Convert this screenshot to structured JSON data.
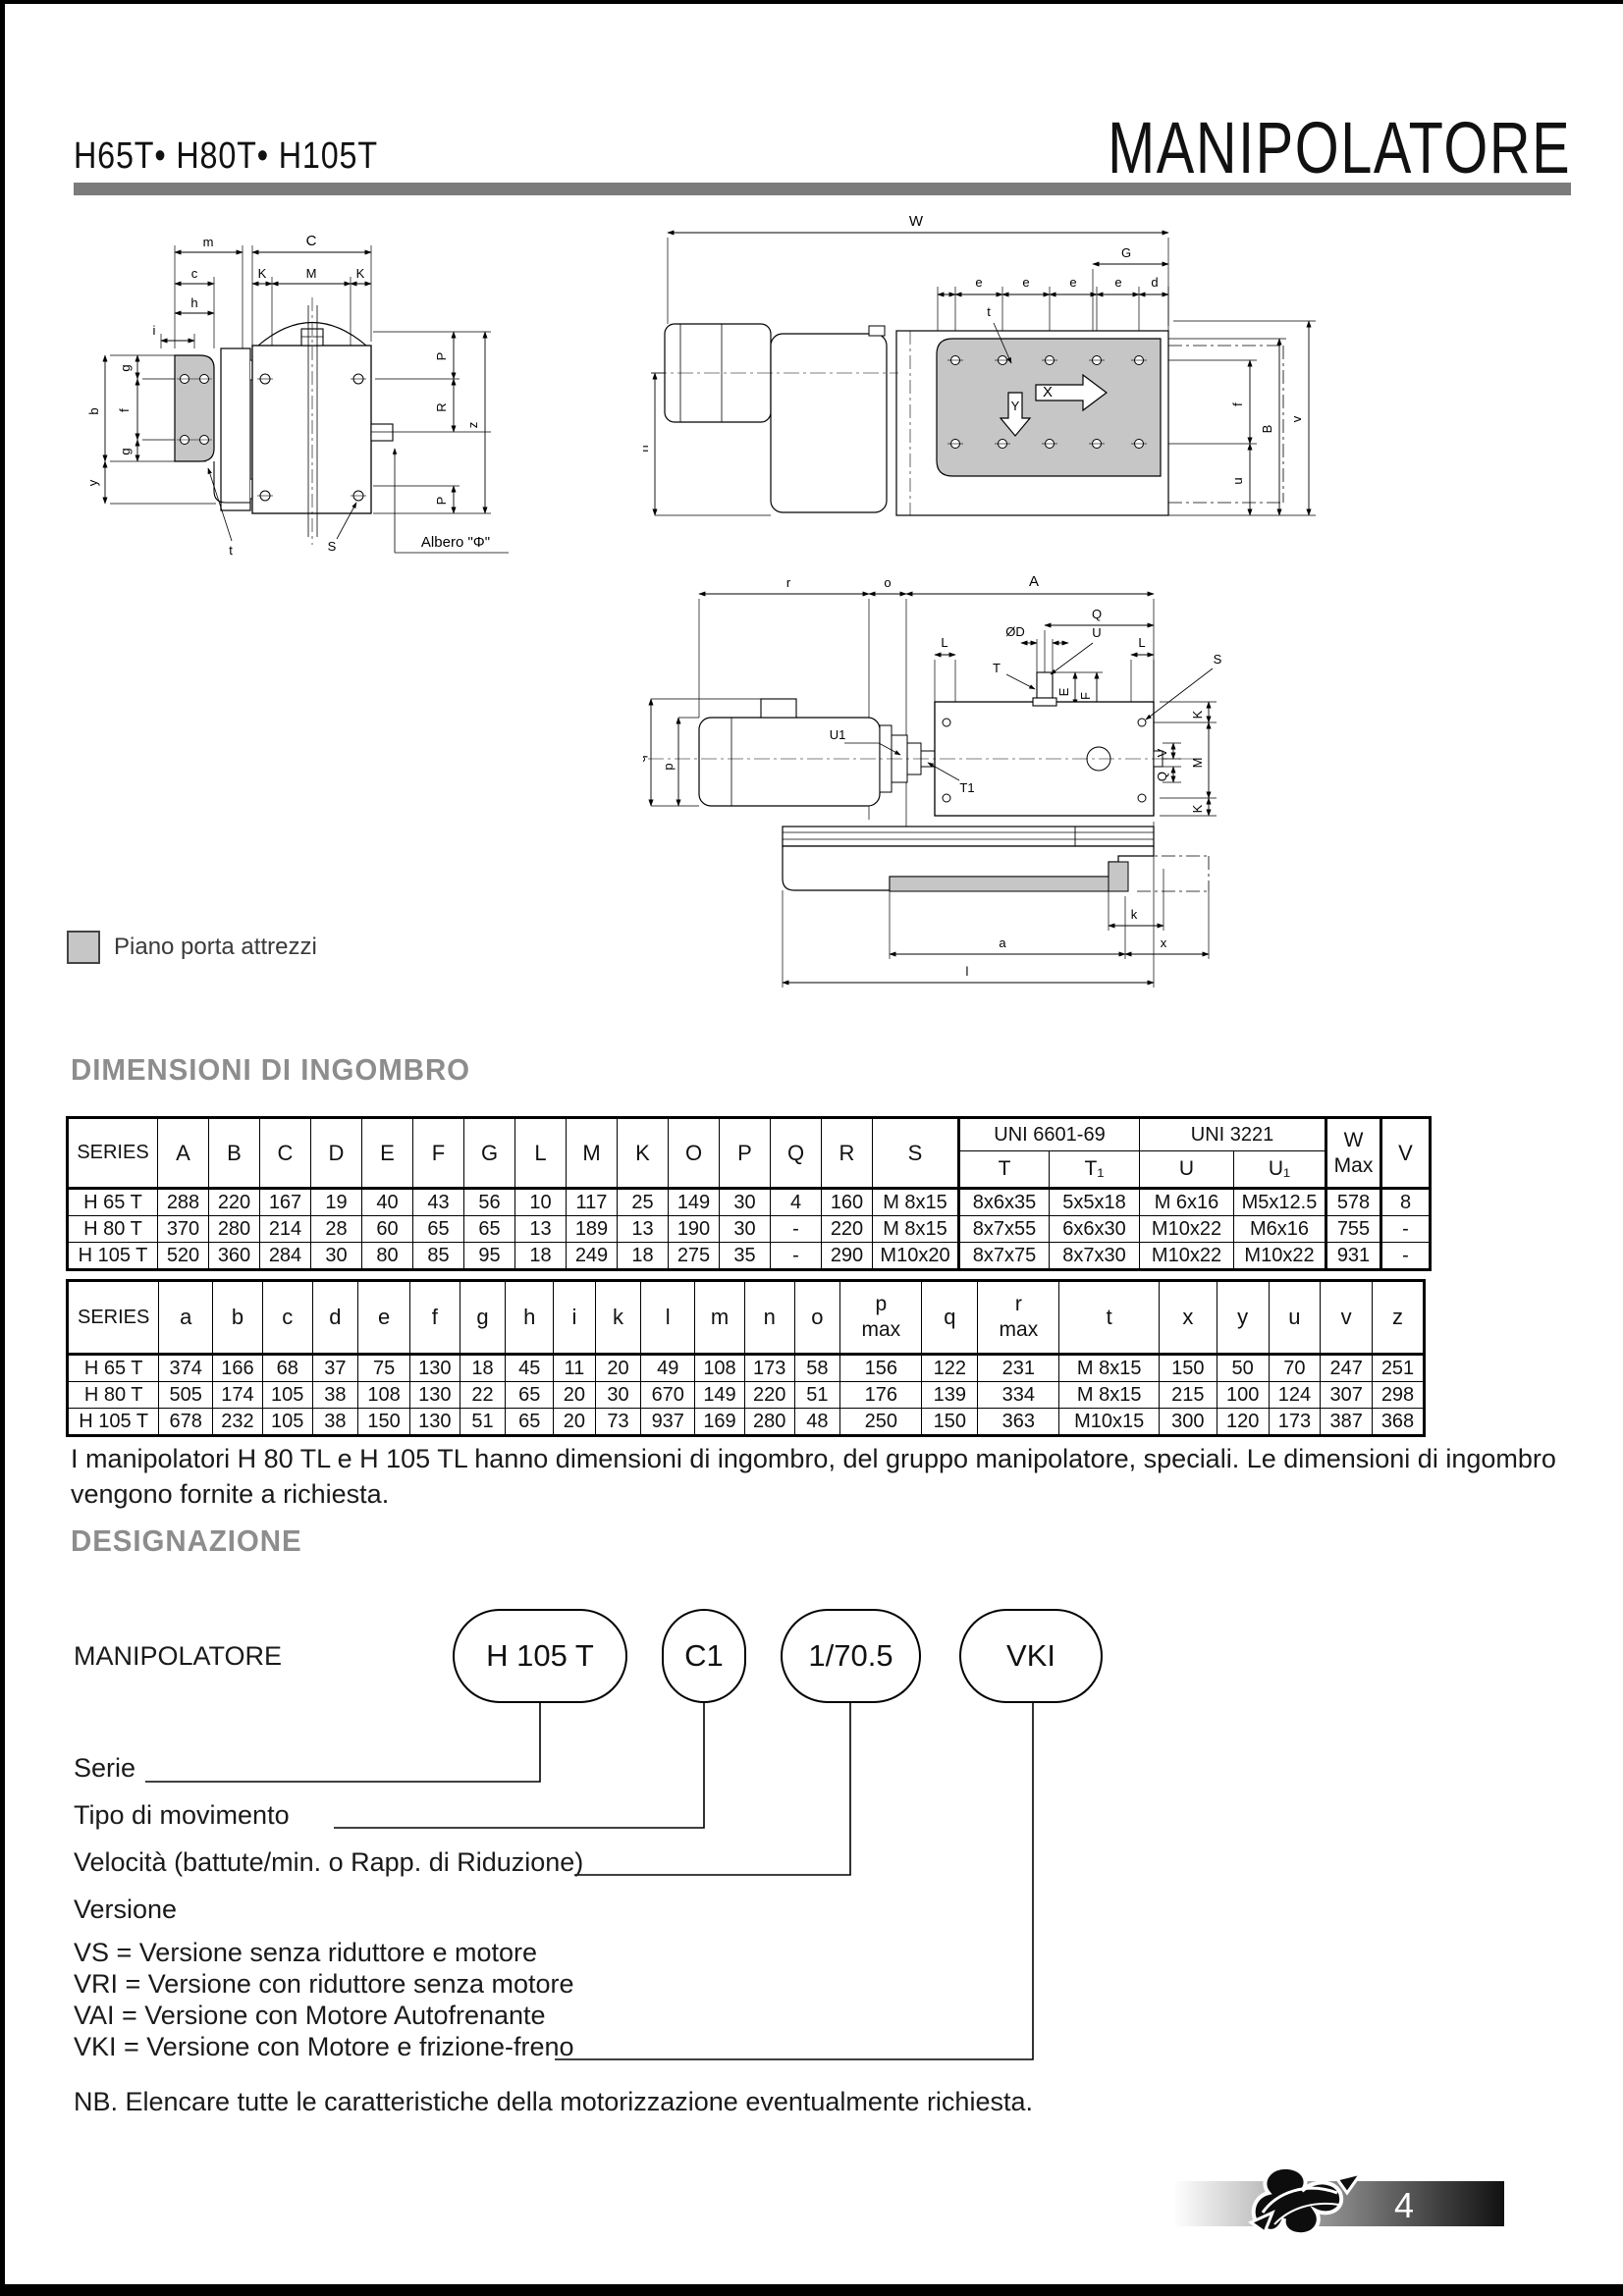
{
  "header": {
    "models": "H65T• H80T• H105T",
    "title": "MANIPOLATORE"
  },
  "legend": {
    "label": "Piano porta attrezzi"
  },
  "headings": {
    "dimensioni": "DIMENSIONI DI INGOMBRO",
    "designazione": "DESIGNAZIONE"
  },
  "drawing1": {
    "m": "m",
    "C": "C",
    "c": "c",
    "K": "K",
    "M": "M",
    "h": "h",
    "i": "i",
    "g": "g",
    "f": "f",
    "b": "b",
    "y": "y",
    "P": "P",
    "R": "R",
    "z": "z",
    "t": "t",
    "S": "S",
    "albero": "Albero \"Φ\""
  },
  "drawing2": {
    "W": "W",
    "G": "G",
    "e": "e",
    "d": "d",
    "t": "t",
    "f": "f",
    "B": "B",
    "u": "u",
    "v": "v",
    "n": "n",
    "X": "X",
    "Y": "Y"
  },
  "drawing3": {
    "r": "r",
    "o": "o",
    "A": "A",
    "Q": "Q",
    "OD": "ØD",
    "U": "U",
    "L": "L",
    "T": "T",
    "E": "E",
    "F": "F",
    "S": "S",
    "q": "q",
    "p": "p",
    "U1": "U1",
    "T1": "T1",
    "V": "V",
    "M": "M",
    "K": "K",
    "k": "k",
    "a": "a",
    "x": "x",
    "l": "l"
  },
  "table1": {
    "series_header": "SERIES",
    "letters": [
      "A",
      "B",
      "C",
      "D",
      "E",
      "F",
      "G",
      "L",
      "M",
      "K",
      "O",
      "P",
      "Q",
      "R",
      "S"
    ],
    "uni1_label": "UNI 6601-69",
    "uni2_label": "UNI 3221",
    "sub_headers": [
      "T",
      "T₁",
      "U",
      "U₁"
    ],
    "w_header": [
      "W",
      "Max"
    ],
    "v_header": "V",
    "rows": [
      [
        "H 65 T",
        "288",
        "220",
        "167",
        "19",
        "40",
        "43",
        "56",
        "10",
        "117",
        "25",
        "149",
        "30",
        "4",
        "160",
        "M 8x15",
        "8x6x35",
        "5x5x18",
        "M 6x16",
        "M5x12.5",
        "578",
        "8"
      ],
      [
        "H 80 T",
        "370",
        "280",
        "214",
        "28",
        "60",
        "65",
        "65",
        "13",
        "189",
        "13",
        "190",
        "30",
        "-",
        "220",
        "M 8x15",
        "8x7x55",
        "6x6x30",
        "M10x22",
        "M6x16",
        "755",
        "-"
      ],
      [
        "H 105 T",
        "520",
        "360",
        "284",
        "30",
        "80",
        "85",
        "95",
        "18",
        "249",
        "18",
        "275",
        "35",
        "-",
        "290",
        "M10x20",
        "8x7x75",
        "8x7x30",
        "M10x22",
        "M10x22",
        "931",
        "-"
      ]
    ]
  },
  "table2": {
    "series_header": "SERIES",
    "letters": [
      "a",
      "b",
      "c",
      "d",
      "e",
      "f",
      "g",
      "h",
      "i",
      "k",
      "l",
      "m",
      "n",
      "o"
    ],
    "pmax": [
      "p",
      "max"
    ],
    "q_header": "q",
    "rmax": [
      "r",
      "max"
    ],
    "tail_letters": [
      "t",
      "x",
      "y",
      "u",
      "v",
      "z"
    ],
    "rows": [
      [
        "H 65 T",
        "374",
        "166",
        "68",
        "37",
        "75",
        "130",
        "18",
        "45",
        "11",
        "20",
        "49",
        "108",
        "173",
        "58",
        "156",
        "122",
        "231",
        "M 8x15",
        "150",
        "50",
        "70",
        "247",
        "251"
      ],
      [
        "H 80 T",
        "505",
        "174",
        "105",
        "38",
        "108",
        "130",
        "22",
        "65",
        "20",
        "30",
        "670",
        "149",
        "220",
        "51",
        "176",
        "139",
        "334",
        "M 8x15",
        "215",
        "100",
        "124",
        "307",
        "298"
      ],
      [
        "H 105 T",
        "678",
        "232",
        "105",
        "38",
        "150",
        "130",
        "51",
        "65",
        "20",
        "73",
        "937",
        "169",
        "280",
        "48",
        "250",
        "150",
        "363",
        "M10x15",
        "300",
        "120",
        "173",
        "387",
        "368"
      ]
    ]
  },
  "note": "I manipolatori H 80 TL e H 105 TL hanno dimensioni di ingombro, del gruppo manipolatore, speciali. Le dimensioni di ingombro vengono fornite a richiesta.",
  "designazione": {
    "label": "MANIPOLATORE",
    "pills": [
      "H 105 T",
      "C1",
      "1/70.5",
      "VKI"
    ],
    "callout_serie": "Serie",
    "callout_tipo": "Tipo di movimento",
    "callout_velocita": "Velocità (battute/min. o Rapp. di Riduzione)",
    "callout_versione": "Versione",
    "versions": [
      "VS = Versione senza riduttore e motore",
      "VRI = Versione con riduttore senza motore",
      "VAI = Versione con Motore Autofrenante",
      "VKI = Versione con Motore e frizione-freno"
    ],
    "nb": "NB. Elencare tutte le caratteristiche della motorizzazione eventualmente richiesta."
  },
  "footer": {
    "page": "4"
  },
  "colors": {
    "rule_gray": "#7b7b7b",
    "heading_gray": "#8d8d8d",
    "plate_gray": "#c6c6c6"
  }
}
